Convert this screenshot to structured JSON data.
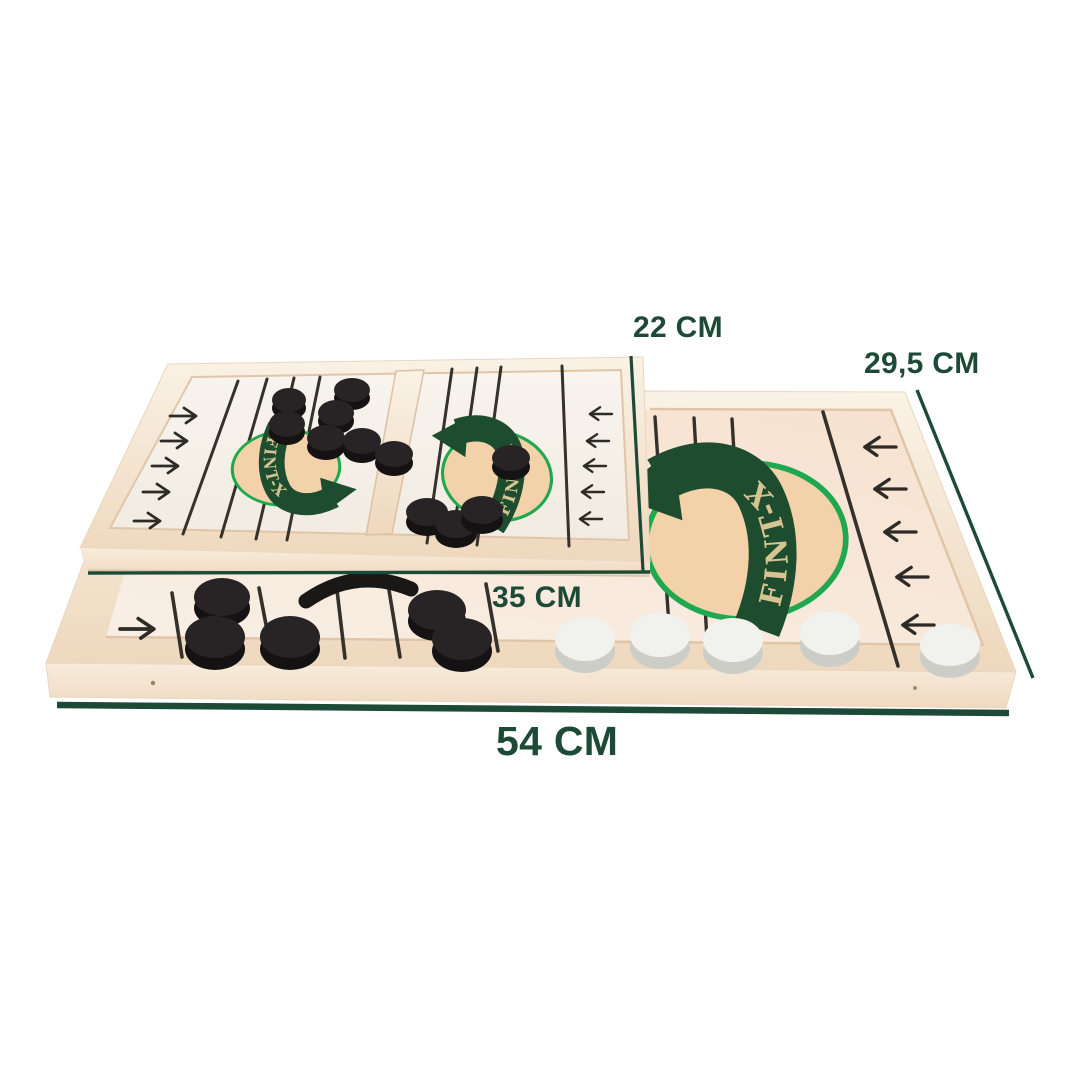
{
  "brand": {
    "logo_text": "FINT-X"
  },
  "dimensions": {
    "small_board_width": "22 CM",
    "big_board_width": "29,5 CM",
    "small_board_length": "35 CM",
    "big_board_length": "54 CM"
  },
  "colors": {
    "accent_green": "#1d4a36",
    "logo_band_green": "#1e4c2e",
    "logo_ring_green": "#1fa850",
    "logo_center_beige": "#f4d2a9",
    "logo_letter_cream": "#d8c492",
    "wood_light": "#f7ecdc",
    "board_surface_white": "#f7f3ee",
    "puck_black": "#272324",
    "puck_white": "#f1f1ee"
  },
  "icons": {
    "board_arrow_right": "→",
    "board_arrow_left": "←",
    "brand_arrow": "curved-swoosh-arrow"
  }
}
